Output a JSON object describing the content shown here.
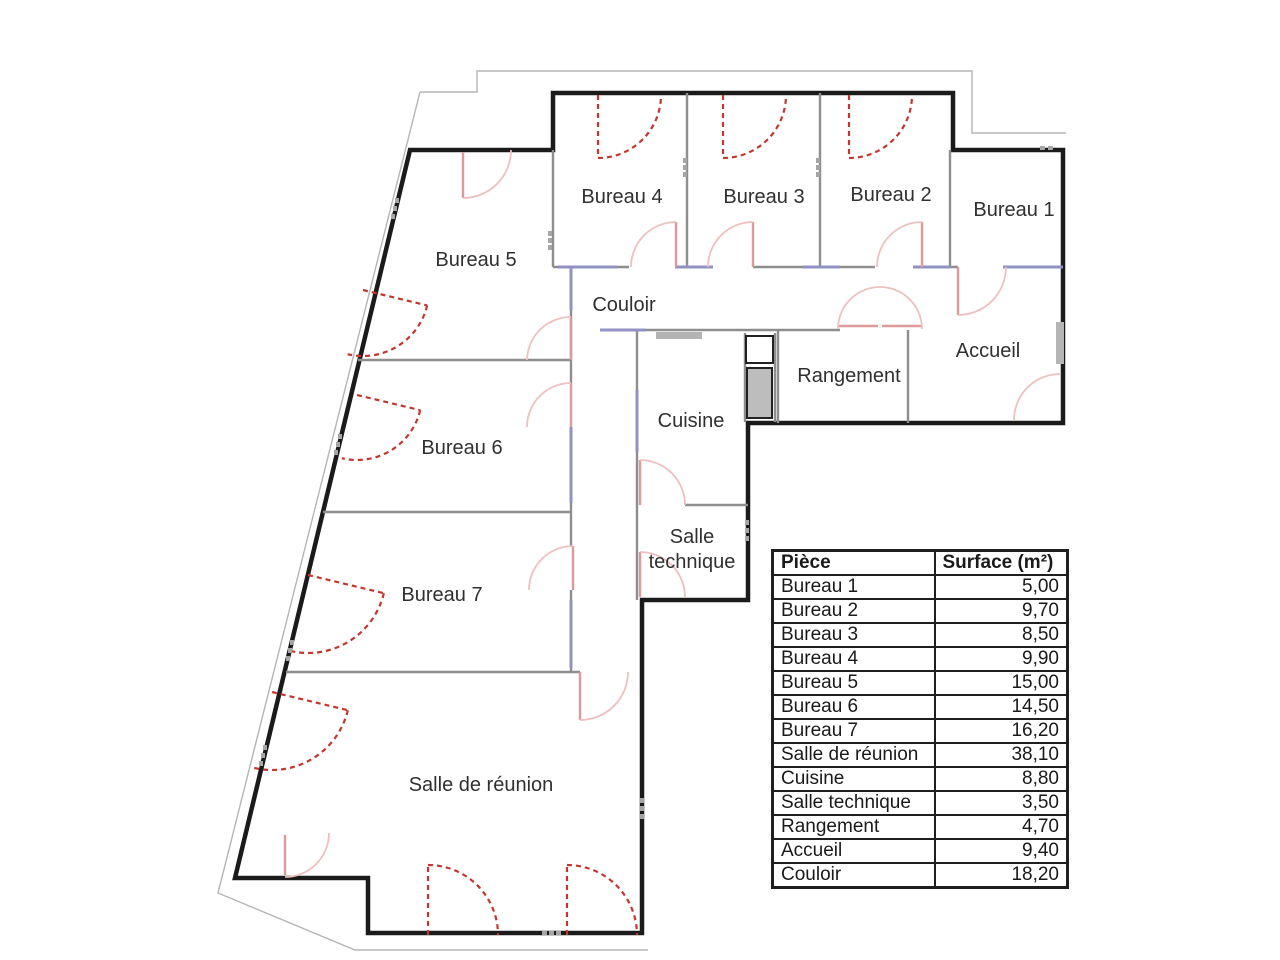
{
  "plan": {
    "title": "Plan de bureaux avec surfaces des pièces",
    "rooms": [
      {
        "id": "bureau-4",
        "label": "Bureau 4"
      },
      {
        "id": "bureau-3",
        "label": "Bureau 3"
      },
      {
        "id": "bureau-2",
        "label": "Bureau 2"
      },
      {
        "id": "bureau-1",
        "label": "Bureau 1"
      },
      {
        "id": "bureau-5",
        "label": "Bureau 5"
      },
      {
        "id": "couloir",
        "label": "Couloir"
      },
      {
        "id": "accueil",
        "label": "Accueil"
      },
      {
        "id": "rangement",
        "label": "Rangement"
      },
      {
        "id": "cuisine",
        "label": "Cuisine"
      },
      {
        "id": "bureau-6",
        "label": "Bureau 6"
      },
      {
        "id": "salle-technique",
        "label": "Salle technique",
        "lines": [
          "Salle",
          "technique"
        ]
      },
      {
        "id": "bureau-7",
        "label": "Bureau 7"
      },
      {
        "id": "salle-de-reunion",
        "label": "Salle de réunion"
      }
    ],
    "colors": {
      "exterior_wall": "#1b1b1b",
      "interior_wall": "#8e8e8e",
      "glazed_partition": "#9292c2",
      "window_swing": "#c2372f",
      "door_swing": "#eec0c0",
      "site_boundary": "#b5b5b5",
      "shaft_fill": "#bdbdbd"
    }
  },
  "table": {
    "headers": [
      "Pièce",
      "Surface (m²)"
    ],
    "rows": [
      {
        "piece": "Bureau 1",
        "surface": "5,00"
      },
      {
        "piece": "Bureau 2",
        "surface": "9,70"
      },
      {
        "piece": "Bureau 3",
        "surface": "8,50"
      },
      {
        "piece": "Bureau 4",
        "surface": "9,90"
      },
      {
        "piece": "Bureau 5",
        "surface": "15,00"
      },
      {
        "piece": "Bureau 6",
        "surface": "14,50"
      },
      {
        "piece": "Bureau 7",
        "surface": "16,20"
      },
      {
        "piece": "Salle de réunion",
        "surface": "38,10"
      },
      {
        "piece": "Cuisine",
        "surface": "8,80"
      },
      {
        "piece": "Salle technique",
        "surface": "3,50"
      },
      {
        "piece": "Rangement",
        "surface": "4,70"
      },
      {
        "piece": "Accueil",
        "surface": "9,40"
      },
      {
        "piece": "Couloir",
        "surface": "18,20"
      }
    ]
  }
}
